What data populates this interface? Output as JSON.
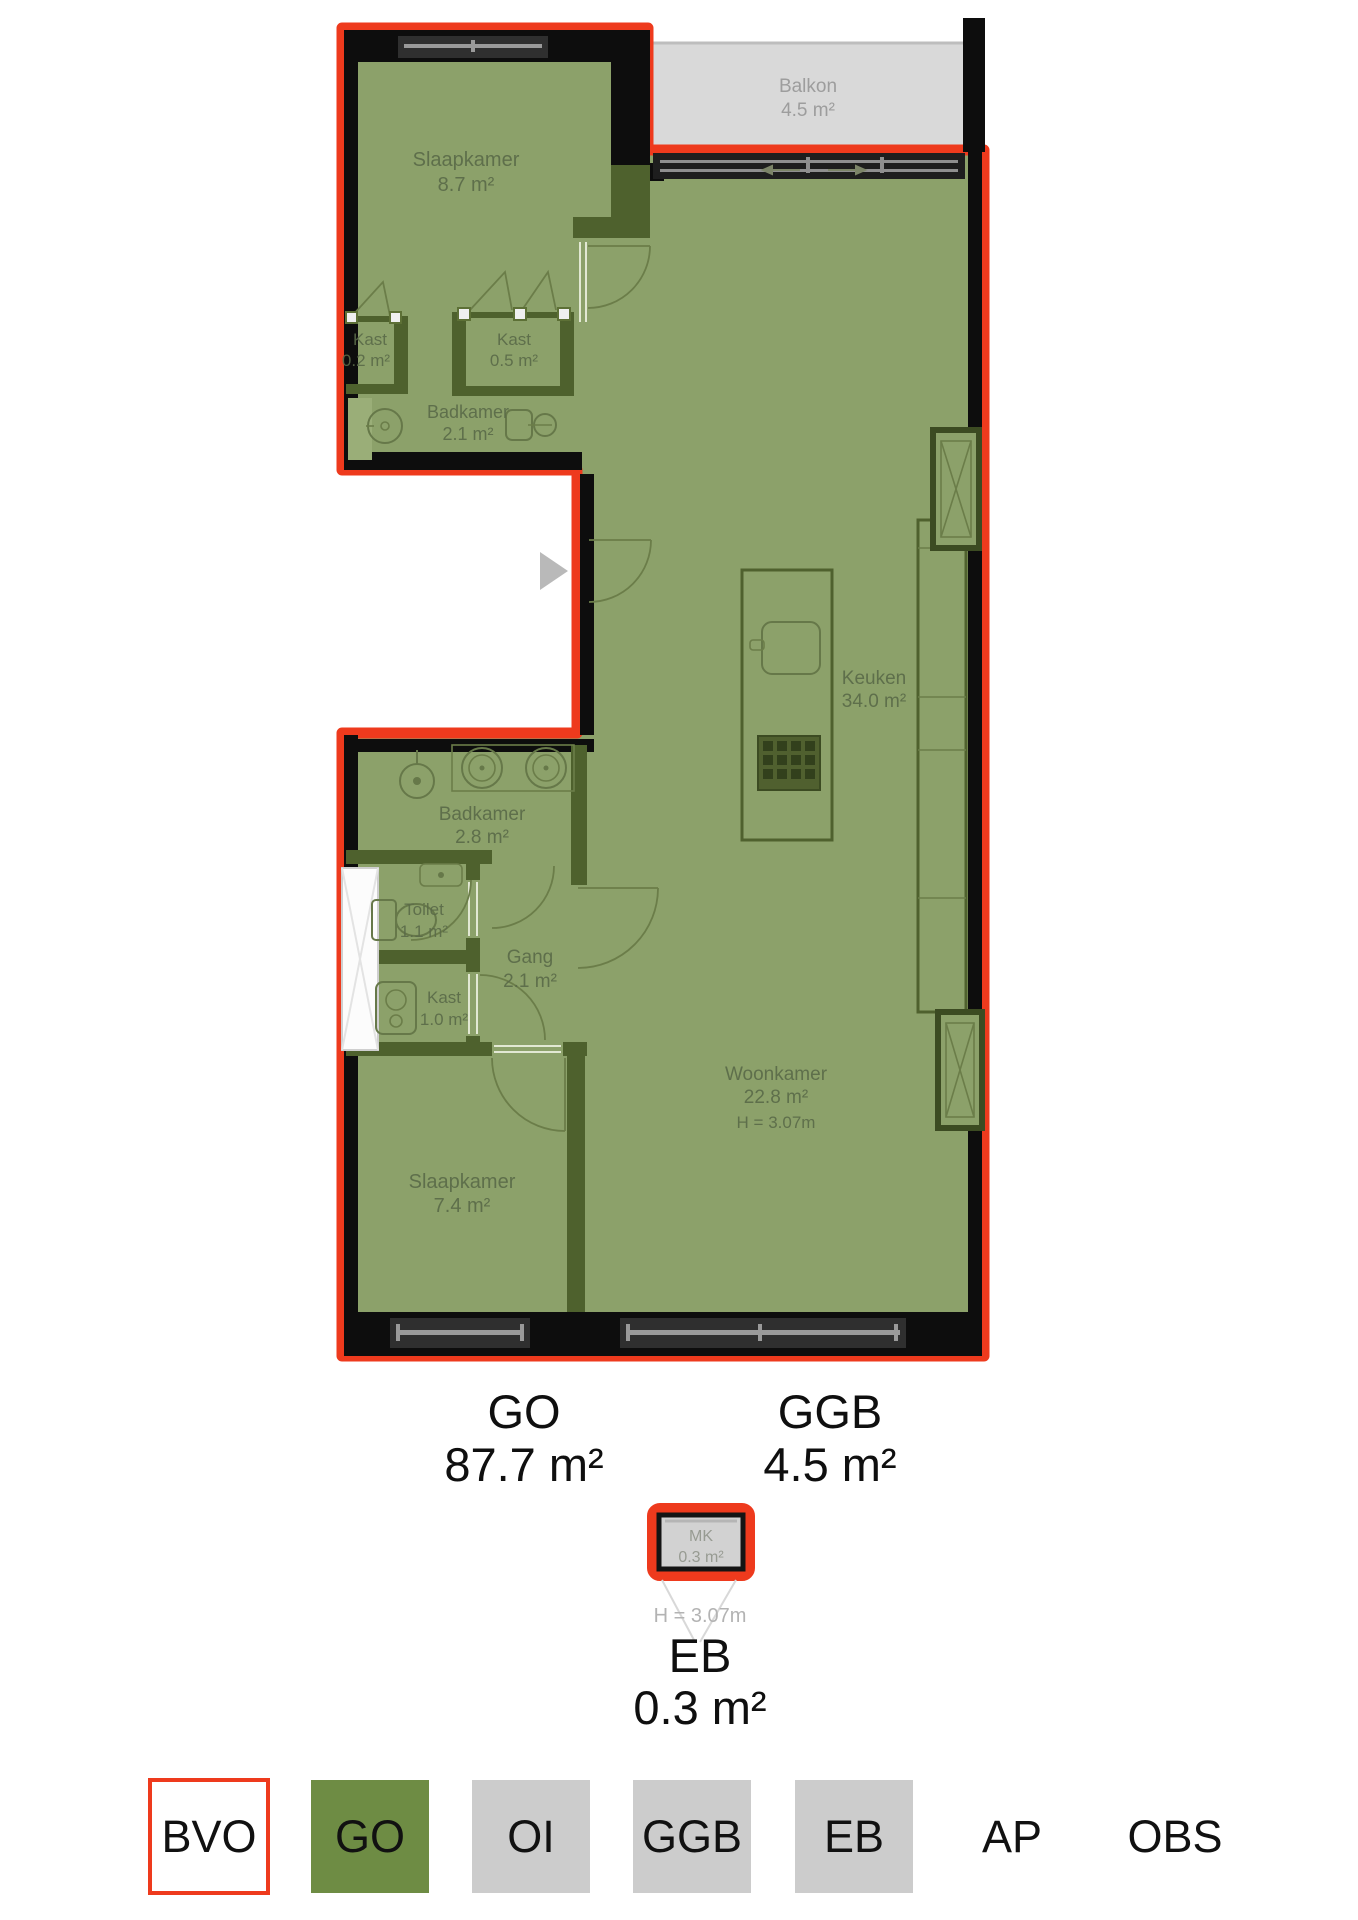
{
  "plan": {
    "rooms": {
      "slaapkamer_1": {
        "name": "Slaapkamer",
        "area": "8.7 m²"
      },
      "kast_1": {
        "name": "Kast",
        "area": "0.2 m²"
      },
      "kast_2": {
        "name": "Kast",
        "area": "0.5 m²"
      },
      "badkamer_1": {
        "name": "Badkamer",
        "area": "2.1 m²"
      },
      "balkon": {
        "name": "Balkon",
        "area": "4.5 m²"
      },
      "keuken": {
        "name": "Keuken",
        "area": "34.0 m²"
      },
      "badkamer_2": {
        "name": "Badkamer",
        "area": "2.8 m²"
      },
      "toilet": {
        "name": "Toilet",
        "area": "1.1 m²"
      },
      "gang": {
        "name": "Gang",
        "area": "2.1 m²"
      },
      "kast_3": {
        "name": "Kast",
        "area": "1.0 m²"
      },
      "woonkamer": {
        "name": "Woonkamer",
        "area": "22.8 m²",
        "height": "H = 3.07m"
      },
      "slaapkamer_2": {
        "name": "Slaapkamer",
        "area": "7.4 m²"
      },
      "mk": {
        "name": "MK",
        "area": "0.3 m²"
      }
    },
    "summary": {
      "go": {
        "label": "GO",
        "area": "87.7 m²"
      },
      "ggb": {
        "label": "GGB",
        "area": "4.5 m²"
      },
      "eb": {
        "label": "EB",
        "area": "0.3 m²",
        "height": "H = 3.07m"
      }
    },
    "legend": {
      "items": [
        {
          "label": "BVO",
          "style": "outline"
        },
        {
          "label": "GO",
          "style": "green"
        },
        {
          "label": "OI",
          "style": "gray"
        },
        {
          "label": "GGB",
          "style": "gray"
        },
        {
          "label": "EB",
          "style": "gray"
        },
        {
          "label": "AP",
          "style": "none"
        },
        {
          "label": "OBS",
          "style": "none"
        }
      ]
    },
    "colors": {
      "bvo_outline": "#ee3a1d",
      "floor_green": "#8ca16a",
      "legend_green": "#6e8c44",
      "legend_gray": "#cccccc",
      "balcony_gray": "#d9d9d9",
      "wall_black": "#0d0d0d"
    }
  }
}
